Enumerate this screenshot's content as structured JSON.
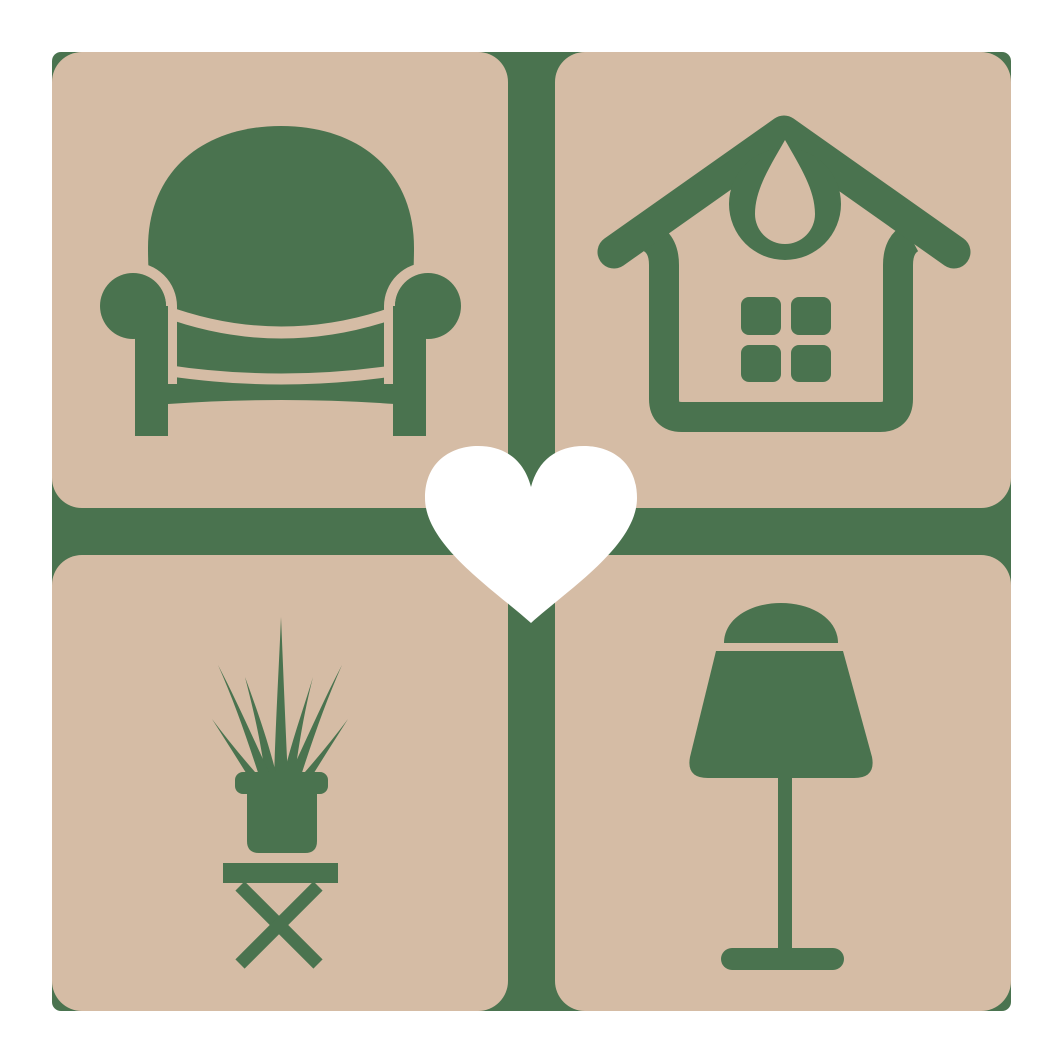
{
  "meta": {
    "description": "Square logo: four rounded tan tiles with dark-green home furnishing icons (armchair, house, potted plant, table lamp) separated by a green cross, with a white heart in the center",
    "background": "#ffffff"
  },
  "colors": {
    "background": "#ffffff",
    "tile": "#d5bca5",
    "icon_green": "#4a734f",
    "heart": "#ffffff"
  },
  "logo": {
    "grid": {
      "rows": 2,
      "cols": 2,
      "tile_size_px": 456,
      "gap_px": 47,
      "origin_px": 52,
      "tile_corner_radius_px": 30,
      "backing_corner_radius_px": 9
    },
    "tiles": [
      {
        "position": "top-left",
        "icon": "armchair-icon",
        "subject": "armchair"
      },
      {
        "position": "top-right",
        "icon": "house-icon",
        "subject": "house with windows and crescent ornament"
      },
      {
        "position": "bottom-left",
        "icon": "potted-plant-icon",
        "subject": "spiky potted plant on cross-legged table"
      },
      {
        "position": "bottom-right",
        "icon": "table-lamp-icon",
        "subject": "table lamp with shade and round base"
      }
    ],
    "center_overlay": {
      "icon": "heart-icon",
      "color": "#ffffff"
    }
  }
}
